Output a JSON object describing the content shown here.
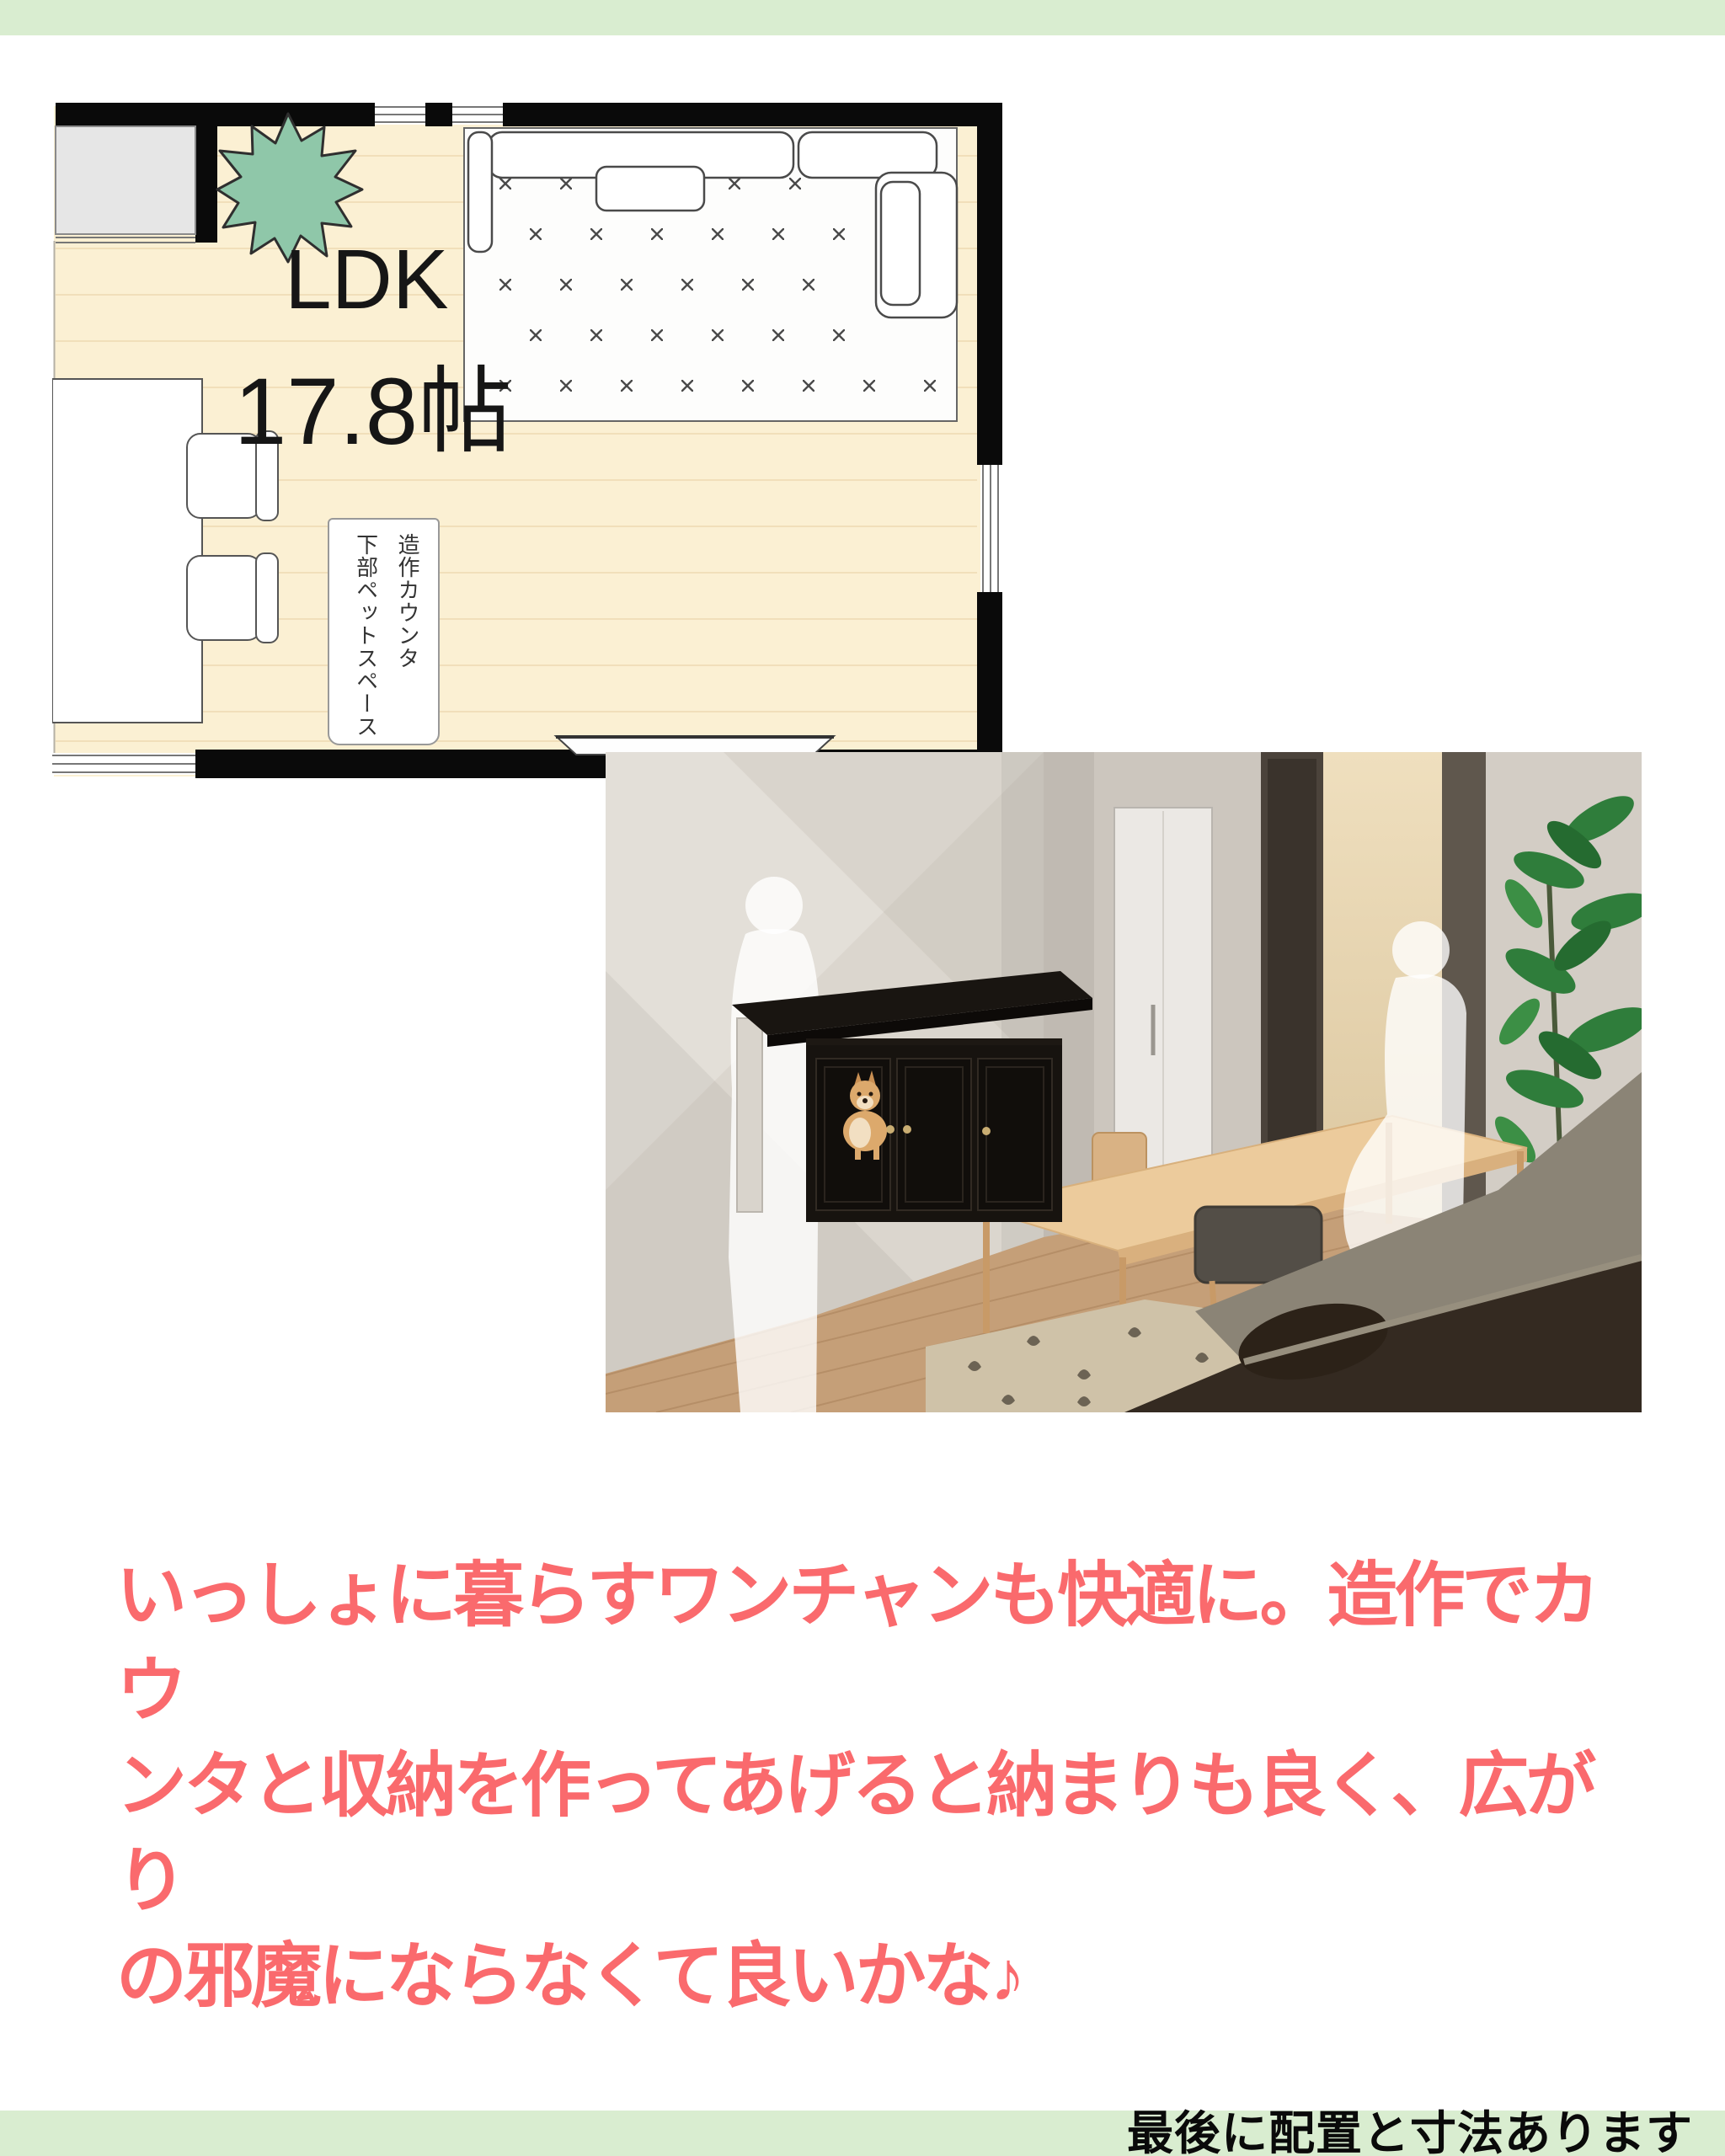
{
  "floor_plan": {
    "room_label": "LDK",
    "area_label": "17.8帖",
    "counter_note": [
      "造作カウンタ",
      "下部ペットスペース"
    ]
  },
  "caption": {
    "lines": [
      "いっしょに暮らすワンチャンも快適に。造作でカウ",
      "ンタと収納を作ってあげると納まりも良く、広がり",
      "の邪魔にならなくて良いかな♪"
    ],
    "color": "#FA6A6D"
  },
  "footer": {
    "note": "最後に配置と寸法あります"
  },
  "palette": {
    "accent_green": "#D9EDD0",
    "floor_cream": "#FBF0D3",
    "plant_green": "#8FC7A9",
    "caption_red": "#FA6A6D",
    "wall_black": "#0A0A0A"
  }
}
